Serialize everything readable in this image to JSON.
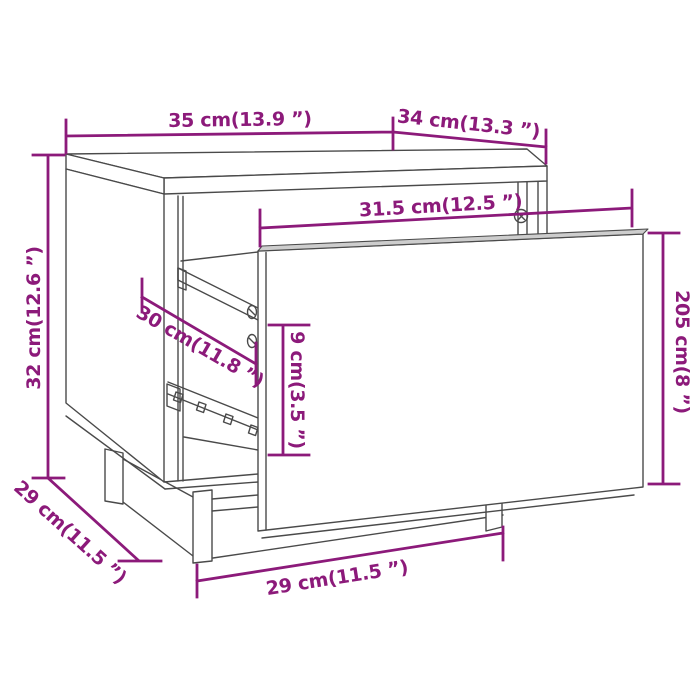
{
  "diagram": {
    "kind": "furniture-dimension-diagram",
    "subject": "bedside-cabinet-with-pulled-out-drawer"
  },
  "labels": {
    "top_width": "35 cm(13.9 ”)",
    "top_depth": "34 cm(13.3 ”)",
    "drawer_inner_width": "31.5 cm(12.5 ”)",
    "side_height": "32 cm(12.6 ”)",
    "drawer_depth": "30 cm(11.8 ”)",
    "drawer_inner_height": "9 cm(3.5 ”)",
    "drawer_front_height": "205 cm(8 ”)",
    "base_depth": "29 cm(11.5 ”)",
    "base_width": "29 cm(11.5 ”)"
  },
  "colors": {
    "dimension_accent": "#8C1A7A",
    "outline": "#4A4A4A",
    "background": "#FFFFFF"
  }
}
